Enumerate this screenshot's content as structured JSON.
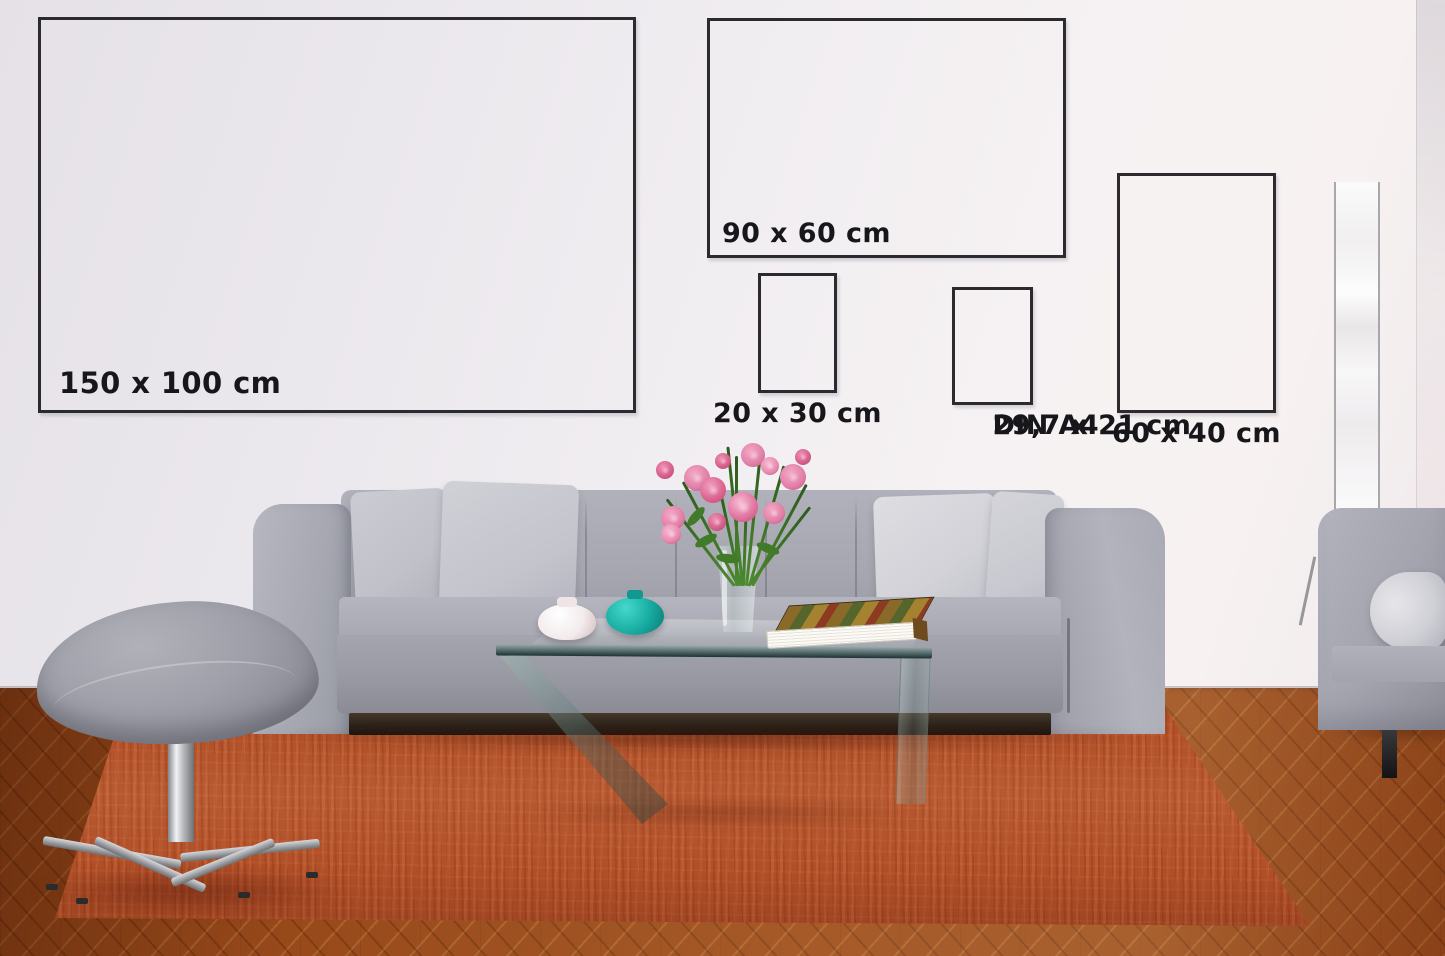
{
  "size_guide": {
    "title_visible": false,
    "frames": [
      {
        "id": "150x100",
        "label": "150 x 100 cm",
        "label_position": "inside-bottom-left"
      },
      {
        "id": "90x60",
        "label": "90 x 60 cm",
        "label_position": "inside-bottom-left"
      },
      {
        "id": "20x30",
        "label": "20 x 30 cm",
        "label_position": "below-center"
      },
      {
        "id": "din_a4",
        "label": "DIN A4",
        "sublabel": "29,7 x 21 cm",
        "label_position": "below-center"
      },
      {
        "id": "60x40",
        "label": "60 x 40 cm",
        "label_position": "below-center"
      }
    ]
  },
  "colors": {
    "frame_border": "#2a2a2f",
    "label_text": "#17171b",
    "wall": "#efecf1",
    "wood_floor": "#98491a",
    "rug": "#b14e26",
    "sofa_gray": "#a9aab4",
    "pillow_gray": "#d2d2d8",
    "plinth_dark": "#2a2118",
    "teal_vase": "#17aaa0",
    "white_vase": "#f3ebec",
    "flower_pink": "#e07da6",
    "leaf_green": "#417a28",
    "stem_green": "#2e5a1d",
    "chrome": "#bcbdc1",
    "lamp_white": "#fbfbfb",
    "glass_edge": "#1d3333",
    "book_brown": "#8a6a28"
  }
}
